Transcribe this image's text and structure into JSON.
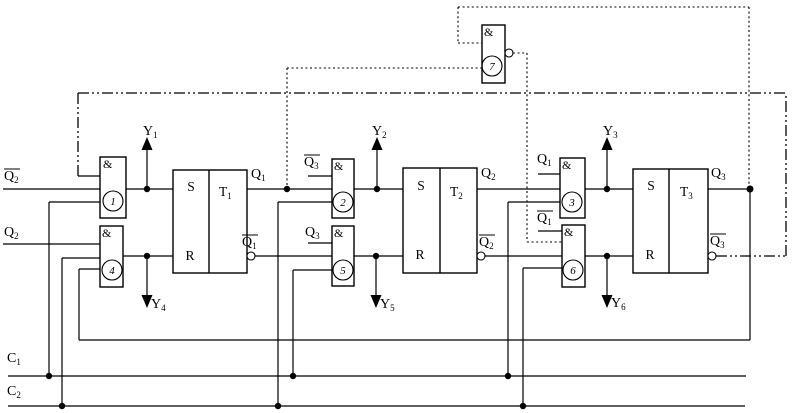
{
  "colors": {
    "line": "#000000",
    "background": "#ffffff"
  },
  "labels": {
    "and": "&",
    "s": "S",
    "r": "R"
  },
  "inputs": {
    "q2bar": {
      "base": "Q",
      "sub": "2",
      "overline": true
    },
    "q2": {
      "base": "Q",
      "sub": "2",
      "overline": false
    },
    "c1": {
      "base": "C",
      "sub": "1"
    },
    "c2": {
      "base": "C",
      "sub": "2"
    }
  },
  "gates": {
    "g1": {
      "number": "1"
    },
    "g2": {
      "number": "2"
    },
    "g3": {
      "number": "3"
    },
    "g4": {
      "number": "4"
    },
    "g5": {
      "number": "5"
    },
    "g6": {
      "number": "6"
    },
    "g7": {
      "number": "7"
    }
  },
  "gate_input_labels": {
    "g2_stub": {
      "base": "Q",
      "sub": "3",
      "overline": true
    },
    "g5_stub": {
      "base": "Q",
      "sub": "3",
      "overline": false
    },
    "g3_stub": {
      "base": "Q",
      "sub": "1",
      "overline": false
    },
    "g6_stub": {
      "base": "Q",
      "sub": "1",
      "overline": true
    }
  },
  "flipflops": {
    "t1": {
      "name": {
        "base": "T",
        "sub": "1"
      },
      "q": {
        "base": "Q",
        "sub": "1",
        "overline": false
      },
      "qbar": {
        "base": "Q",
        "sub": "1",
        "overline": true
      }
    },
    "t2": {
      "name": {
        "base": "T",
        "sub": "2"
      },
      "q": {
        "base": "Q",
        "sub": "2",
        "overline": false
      },
      "qbar": {
        "base": "Q",
        "sub": "2",
        "overline": true
      }
    },
    "t3": {
      "name": {
        "base": "T",
        "sub": "3"
      },
      "q": {
        "base": "Q",
        "sub": "3",
        "overline": false
      },
      "qbar": {
        "base": "Q",
        "sub": "3",
        "overline": true
      }
    }
  },
  "y_outputs": {
    "y1": {
      "base": "Y",
      "sub": "1"
    },
    "y2": {
      "base": "Y",
      "sub": "2"
    },
    "y3": {
      "base": "Y",
      "sub": "3"
    },
    "y4": {
      "base": "Y",
      "sub": "4"
    },
    "y5": {
      "base": "Y",
      "sub": "5"
    },
    "y6": {
      "base": "Y",
      "sub": "6"
    }
  }
}
